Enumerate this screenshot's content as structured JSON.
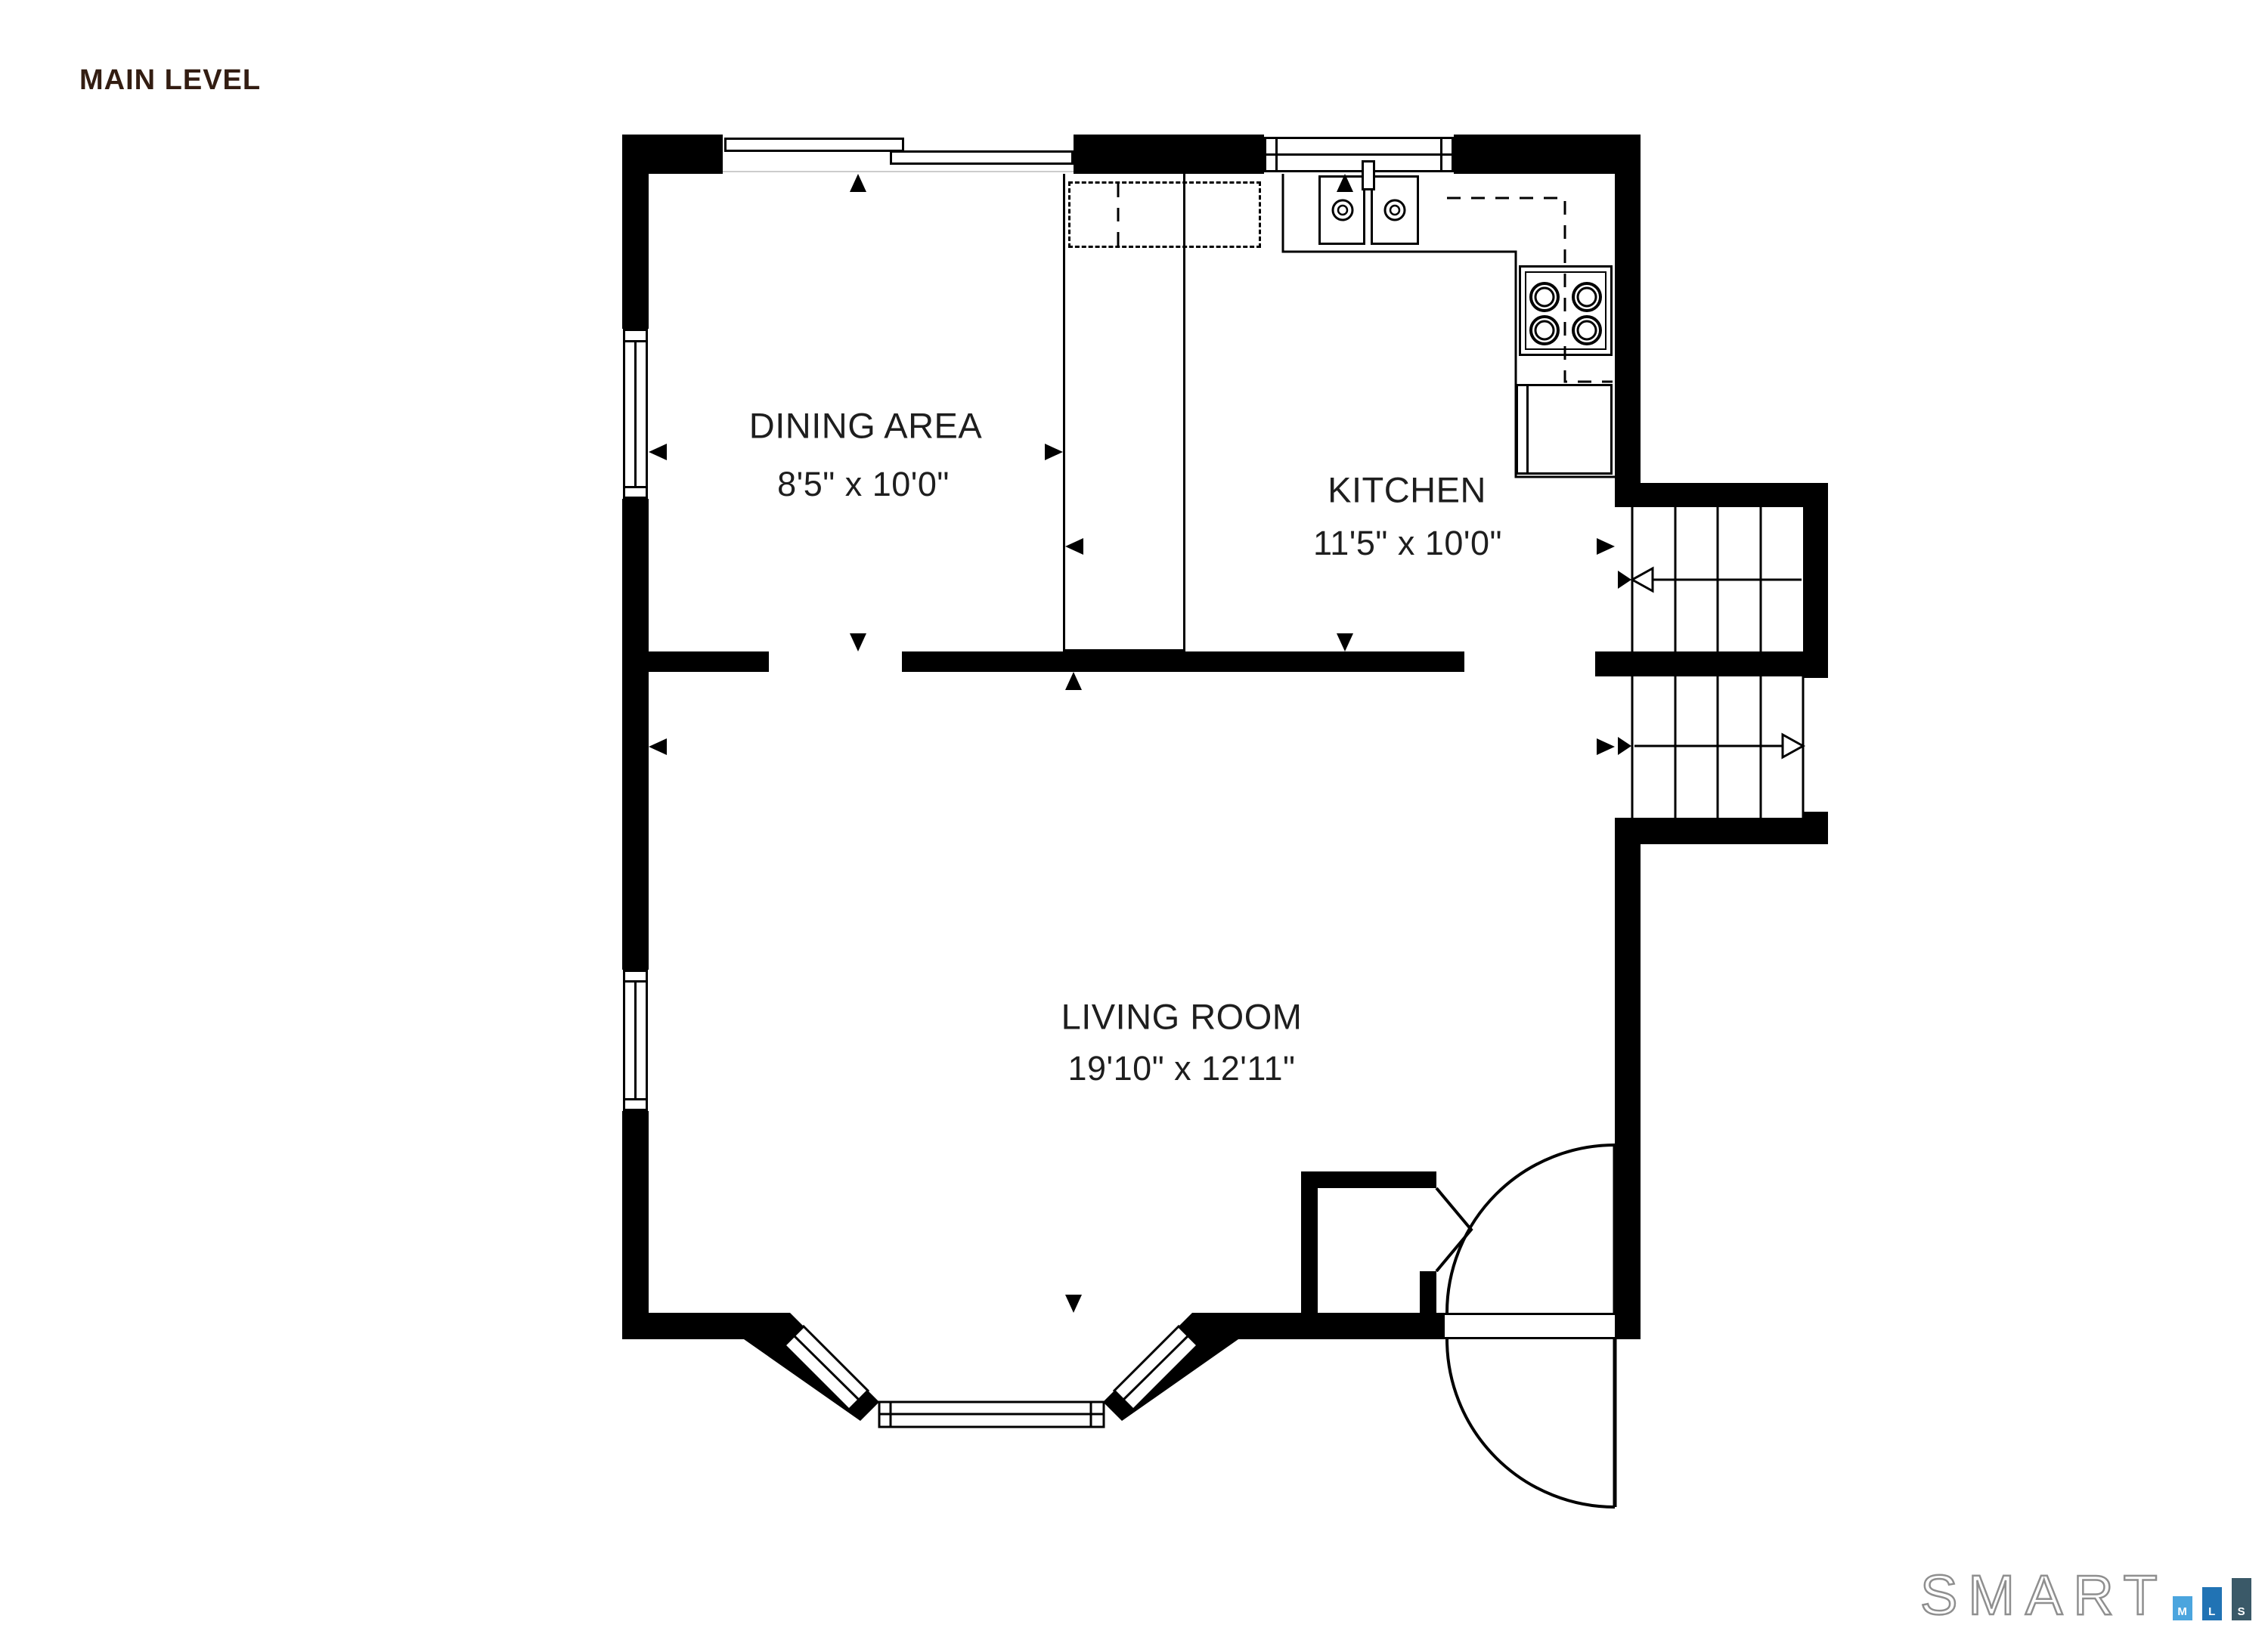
{
  "title": "MAIN LEVEL",
  "rooms": [
    {
      "name": "DINING AREA",
      "dimensions": "8'5\" x 10'0\""
    },
    {
      "name": "KITCHEN",
      "dimensions": "11'5\" x 10'0\""
    },
    {
      "name": "LIVING ROOM",
      "dimensions": "19'10\" x 12'11\""
    }
  ],
  "logo": {
    "brand": "SMART",
    "bars": [
      {
        "label": "M",
        "color": "#4BA5DE"
      },
      {
        "label": "L",
        "color": "#2173B4"
      },
      {
        "label": "S",
        "color": "#3A5968"
      }
    ]
  },
  "colors": {
    "title": "#331D12",
    "walls": "#000000",
    "background": "#FFFFFF",
    "logo_outline": "#8F8F8F"
  }
}
